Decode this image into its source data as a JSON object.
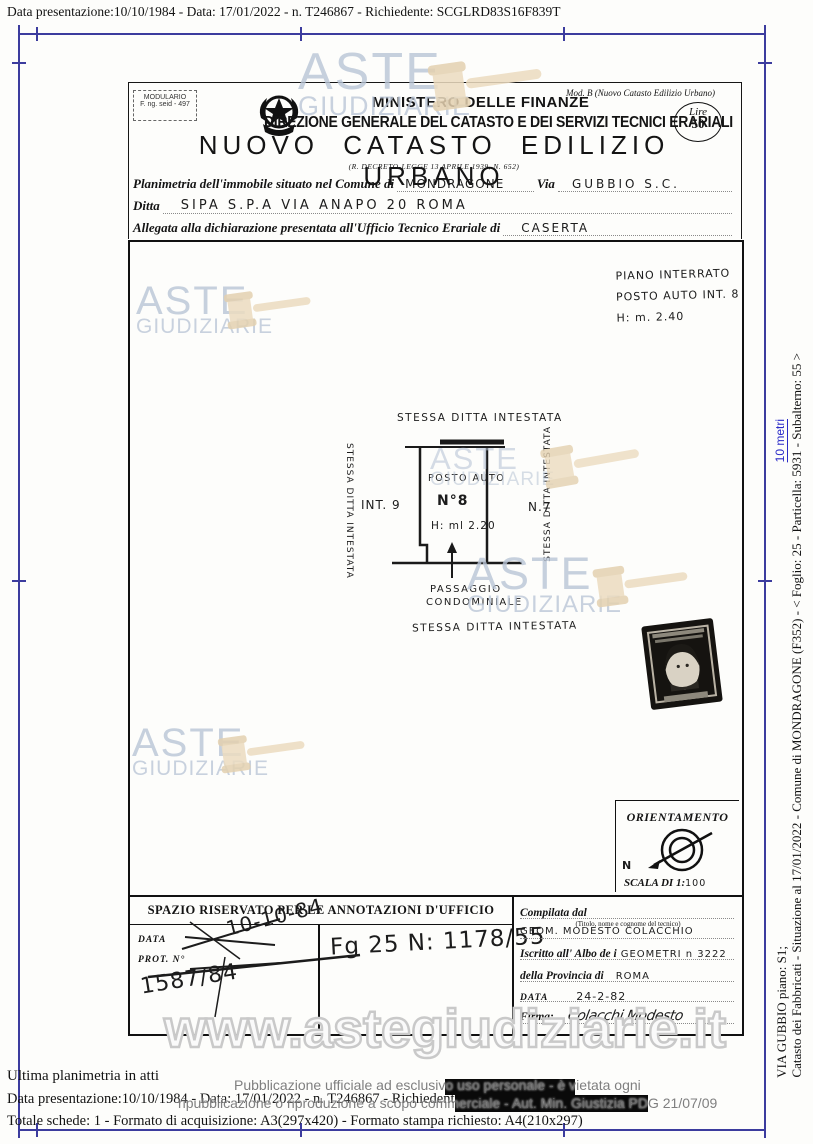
{
  "top_line": "Data presentazione:10/10/1984 - Data: 17/01/2022 - n. T246867 - Richiedente: SCGLRD83S16F839T",
  "header": {
    "modulario_line1": "MODULARIO",
    "modulario_line2": "F. ng. seid - 497",
    "ministry": "MINISTERO DELLE FINANZE",
    "direzione": "DIREZIONE GENERALE DEL CATASTO E DEI SERVIZI TECNICI ERARIALI",
    "mod_b": "Mod. B (Nuovo Catasto Edilizio Urbano)",
    "lire_label": "Lire",
    "lire_value": "50",
    "title": "NUOVO CATASTO EDILIZIO URBANO",
    "decree": "(R. DECRETO-LEGGE 13 APRILE 1939, N. 652)"
  },
  "form": {
    "line1_label": "Planimetria dell'immobile situato nel Comune di",
    "line1_value": "MONDRAGONE",
    "via_label": "Via",
    "via_value": "GUBBIO   S.C.",
    "line2_label": "Ditta",
    "line2_value": "SIPA S.P.A    VIA ANAPO 20 ROMA",
    "line3_label": "Allegata alla dichiarazione presentata all'Ufficio Tecnico Erariale di",
    "line3_value": "CASERTA"
  },
  "plan": {
    "notes": [
      "PIANO INTERRATO",
      "POSTO AUTO INT. 8",
      "H: m. 2.40"
    ],
    "label_top": "STESSA DITTA INTESTATA",
    "label_left": "STESSA DITTA INTESTATA",
    "label_right": "STESSA DITTA INTESTATA",
    "label_bottom": "STESSA DITTA INTESTATA",
    "int9": "INT. 9",
    "n7": "N.7",
    "posto_auto": "POSTO AUTO",
    "n8": "N°8",
    "height": "H: ml 2.20",
    "passaggio_line1": "PASSAGGIO",
    "passaggio_line2": "CONDOMINIALE",
    "orientamento": "ORIENTAMENTO",
    "north": "N",
    "scala_label": "SCALA DI 1:",
    "scala_value": "100"
  },
  "annotations": {
    "header": "SPAZIO RISERVATO PER LE ANNOTAZIONI D'UFFICIO",
    "data_label": "DATA",
    "prot_label": "PROT. N°",
    "hand_date": "10-10-84",
    "hand_prot": "1587/84",
    "hand_fg": "Fg 25 N: 1178/55"
  },
  "compiler": {
    "compilata_label": "Compilata dal",
    "compilata_value": "GEOM. MODESTO COLACCHIO",
    "subtitle": "(Titolo, nome e cognome del tecnico)",
    "albo_label": "Iscritto all' Albo de i",
    "albo_value": "GEOMETRI  n 3222",
    "provincia_label": "della Provincia di",
    "provincia_value": "ROMA",
    "data_label": "DATA",
    "data_value": "24-2-82",
    "firma_label": "Firma:",
    "firma_value": "Colacchi Modesto"
  },
  "watermark": {
    "aste": "ASTE",
    "giudiziarie": "GIUDIZIARIE",
    "url": "www.astegiudiziarie.it",
    "text_color": "#b9c5d6",
    "gavel_color": "#ecdcc0"
  },
  "sidebar": {
    "line1": "Catasto dei Fabbricati - Situazione al 17/01/2022 - Comune di MONDRAGONE (F352) - <  Foglio: 25 - Particella: 5931 - Subalterno: 55 >",
    "line2": "VIA GUBBIO piano: S1;",
    "scale_link": "10 metri",
    "link_color": "#2a2ac8"
  },
  "footer": {
    "ultima": "Ultima planimetria in atti",
    "line1": "Data presentazione:10/10/1984 - Data: 17/01/2022 - n. T246867 - Richiedente:",
    "line2": "Totale schede: 1 - Formato di acquisizione: A3(297x420) - Formato stampa richiesto: A4(210x297)",
    "disclaimer1": "Pubblicazione ufficiale ad esclusivo uso personale - è vietata ogni",
    "disclaimer2": "ripubblicazione o riproduzione a scopo commerciale - Aut. Min. Giustizia PDG 21/07/09"
  }
}
